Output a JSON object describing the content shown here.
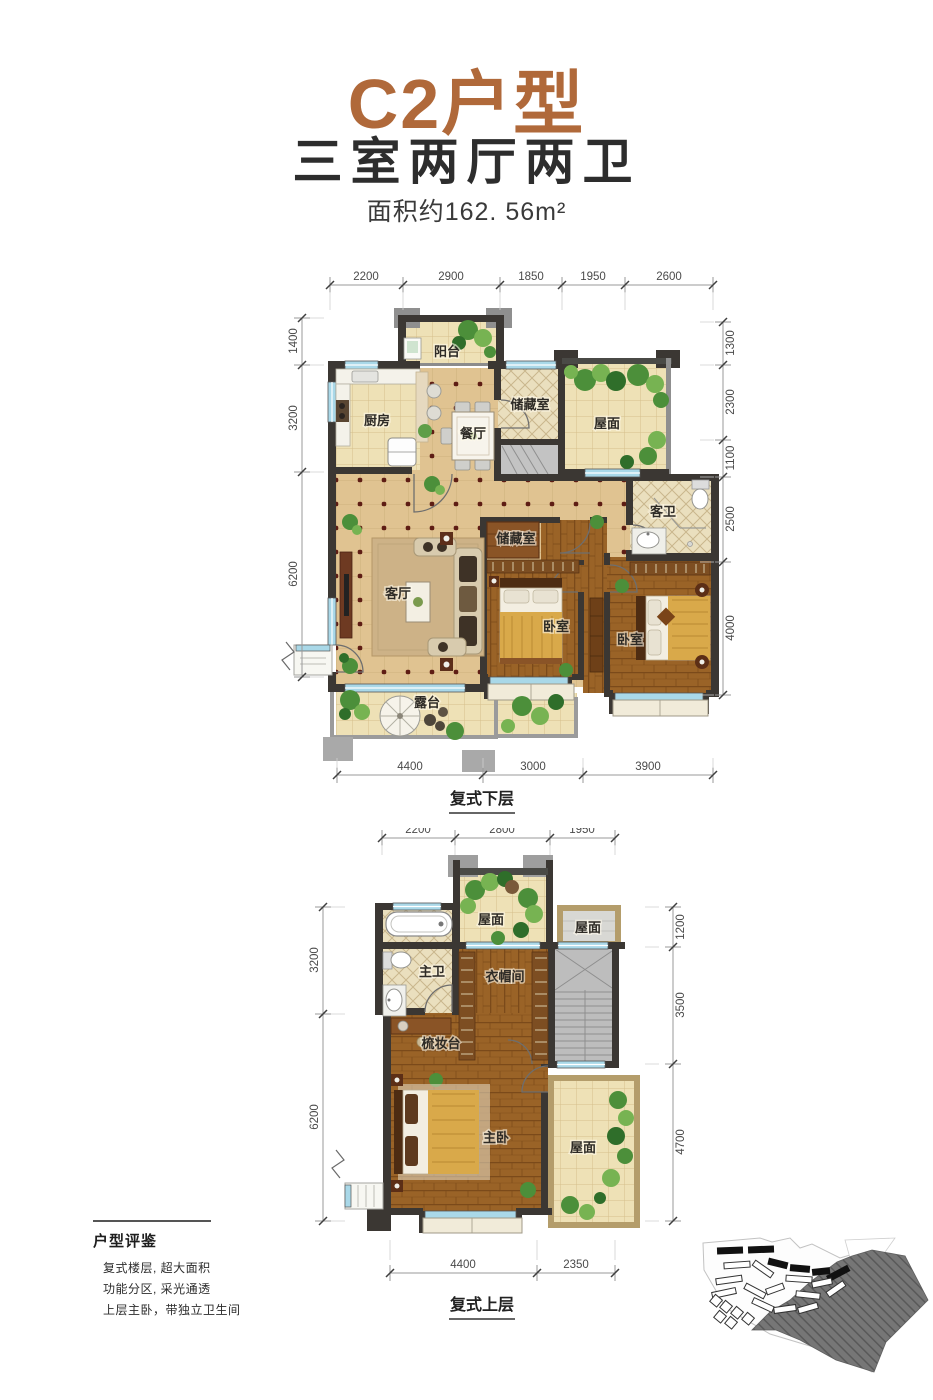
{
  "header": {
    "title": "C2户型",
    "subtitle": "三室两厅两卫",
    "area": "面积约162. 56m²"
  },
  "plan_lower": {
    "caption": "复式下层",
    "dims_top": [
      "2200",
      "2900",
      "1850",
      "1950",
      "2600"
    ],
    "dims_bottom": [
      "4400",
      "3000",
      "3900"
    ],
    "dims_left": [
      "1400",
      "3200",
      "6200"
    ],
    "dims_right": [
      "1300",
      "2300",
      "1100",
      "2500",
      "4000"
    ],
    "rooms": {
      "balcony": "阳台",
      "kitchen": "厨房",
      "dining": "餐厅",
      "storage_top": "储藏室",
      "roof": "屋面",
      "guest_bath": "客卫",
      "living": "客厅",
      "storage_mid": "储藏室",
      "bedroom_1": "卧室",
      "bedroom_2": "卧室",
      "terrace": "露台"
    }
  },
  "plan_upper": {
    "caption": "复式上层",
    "dims_top": [
      "2200",
      "2800",
      "1950"
    ],
    "dims_bottom": [
      "4400",
      "2350"
    ],
    "dims_left": [
      "3200",
      "6200"
    ],
    "dims_right": [
      "1200",
      "3500",
      "4700"
    ],
    "rooms": {
      "roof_main": "屋面",
      "roof_side": "屋面",
      "master_bath": "主卫",
      "cloakroom": "衣帽间",
      "dresser": "梳妆台",
      "master_bedroom": "主卧",
      "roof_lower": "屋面"
    }
  },
  "review": {
    "title": "户型评鉴",
    "line1": "复式楼层, 超大面积",
    "line2": "功能分区, 采光通透",
    "line3": "上层主卧，带独立卫生间"
  },
  "colors": {
    "accent_brown": "#b0693a",
    "wall": "#3b3733",
    "window_blue": "#a9d8e8",
    "floor_tan": "#e0c391",
    "wood": "#9a6327",
    "greenery": "#4c8f3a"
  }
}
